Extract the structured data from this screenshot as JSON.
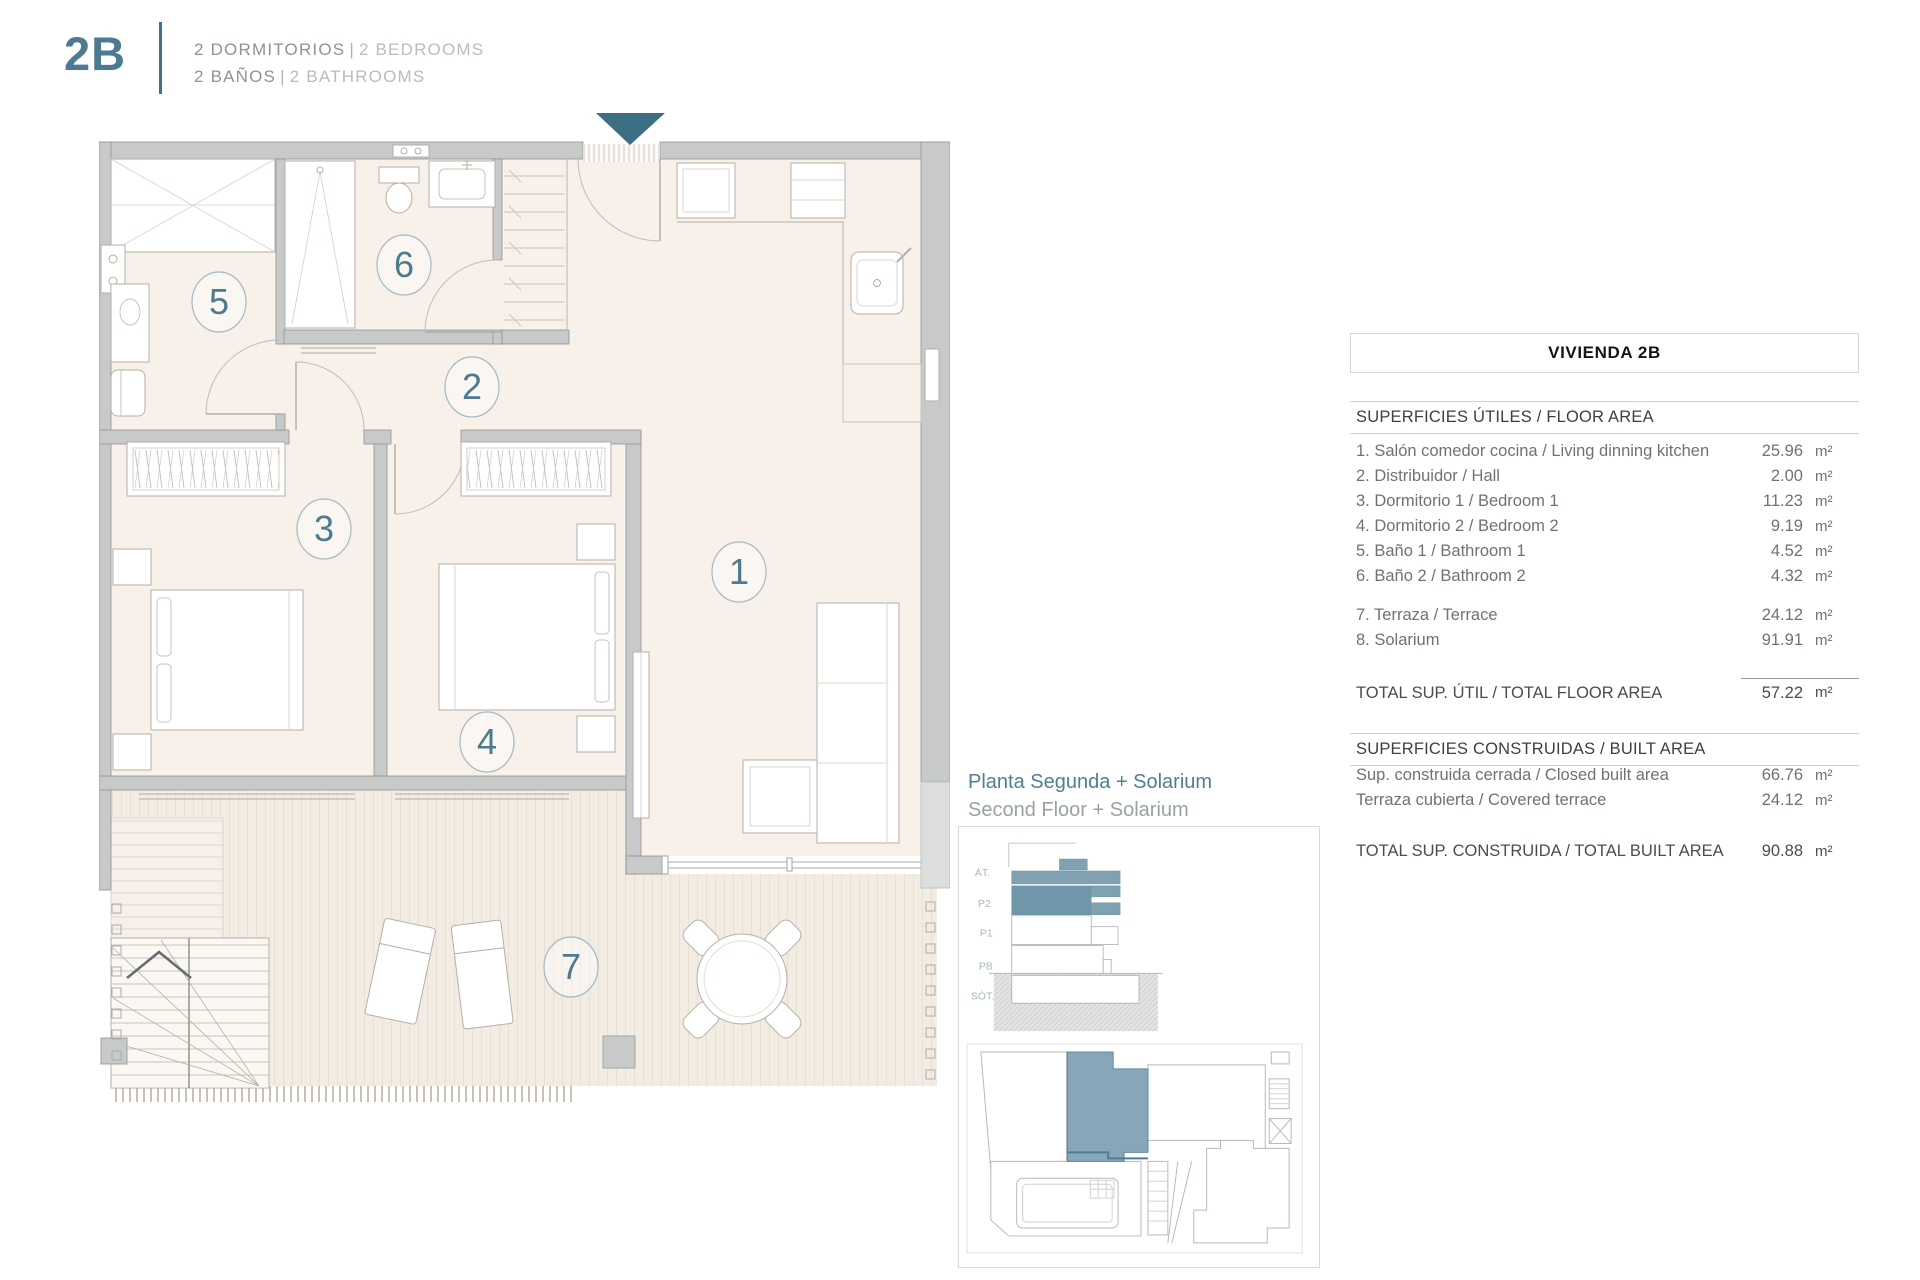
{
  "header": {
    "unit": "2B",
    "line1_primary": "2 DORMITORIOS",
    "line1_sep": "|",
    "line1_secondary": "2 BEDROOMS",
    "line2_primary": "2 BAÑOS",
    "line2_sep": "|",
    "line2_secondary": "2 BATHROOMS"
  },
  "plan": {
    "rooms": [
      {
        "number": "1"
      },
      {
        "number": "2"
      },
      {
        "number": "3"
      },
      {
        "number": "4"
      },
      {
        "number": "5"
      },
      {
        "number": "6"
      },
      {
        "number": "7"
      }
    ]
  },
  "key_plan": {
    "title_es": "Planta Segunda + Solarium",
    "title_en": "Second Floor + Solarium",
    "floor_labels": [
      "ÁT.",
      "P2",
      "P1",
      "PB",
      "SÓT."
    ]
  },
  "table": {
    "title": "VIVIENDA 2B",
    "sections": [
      {
        "heading": "SUPERFICIES ÚTILES / FLOOR AREA",
        "rows": [
          {
            "label": "1. Salón comedor cocina / Living dinning kitchen",
            "value": "25.96",
            "unit": "m²"
          },
          {
            "label": "2. Distribuidor / Hall",
            "value": "2.00",
            "unit": "m²"
          },
          {
            "label": "3. Dormitorio 1 / Bedroom 1",
            "value": "11.23",
            "unit": "m²"
          },
          {
            "label": "4. Dormitorio 2 / Bedroom 2",
            "value": "9.19",
            "unit": "m²"
          },
          {
            "label": "5. Baño 1 / Bathroom 1",
            "value": "4.52",
            "unit": "m²"
          },
          {
            "label": "6. Baño 2 / Bathroom 2",
            "value": "4.32",
            "unit": "m²"
          }
        ],
        "rows2": [
          {
            "label": "7. Terraza / Terrace",
            "value": "24.12",
            "unit": "m²"
          },
          {
            "label": "8. Solarium",
            "value": "91.91",
            "unit": "m²"
          }
        ],
        "total": {
          "label": "TOTAL SUP. ÚTIL / TOTAL FLOOR AREA",
          "value": "57.22",
          "unit": "m²"
        }
      },
      {
        "heading": "SUPERFICIES CONSTRUIDAS / BUILT AREA",
        "rows": [
          {
            "label": "Sup. construida cerrada / Closed built area",
            "value": "66.76",
            "unit": "m²"
          },
          {
            "label": "Terraza cubierta / Covered terrace",
            "value": "24.12",
            "unit": "m²"
          }
        ],
        "total": {
          "label": "TOTAL SUP. CONSTRUIDA /  TOTAL BUILT AREA",
          "value": "90.88",
          "unit": "m²"
        }
      }
    ]
  },
  "colors": {
    "accent": "#4c7a90",
    "accent_dark": "#3c6e84",
    "wall": "#c8cac9",
    "floor": "#f7f1ea",
    "deck": "#f3ece3",
    "highlight_unit": "#87a7b8"
  }
}
